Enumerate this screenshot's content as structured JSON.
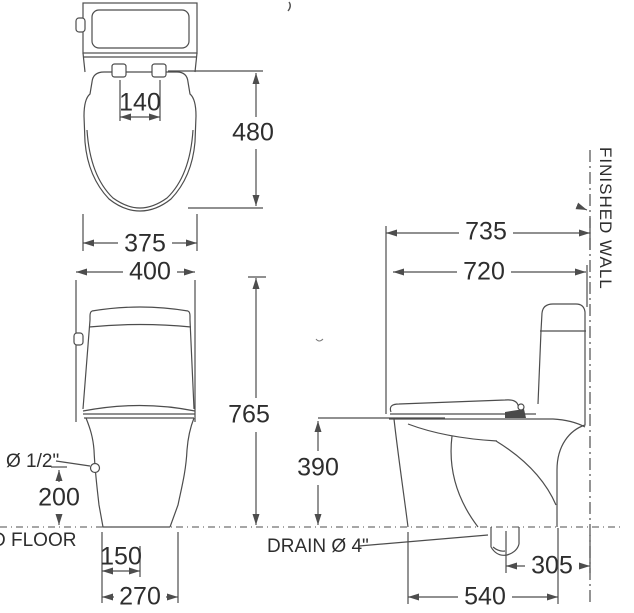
{
  "drawing": {
    "type": "toilet installation dimension diagram",
    "units": "mm",
    "top_view": {
      "hinge_spacing": "140",
      "depth": "480",
      "width": "375"
    },
    "front_view": {
      "width": "400",
      "total_height": "765",
      "inlet_label": "Ø 1/2\"",
      "inlet_height": "200",
      "floor_label": "D FLOOR",
      "base_inner_width": "150",
      "base_width": "270"
    },
    "side_view": {
      "depth_to_wall": "735",
      "body_depth": "720",
      "bowl_height": "390",
      "drain_label": "DRAIN Ø 4\"",
      "drain_to_wall": "305",
      "base_depth": "540",
      "wall_label": "FINISHED WALL"
    }
  }
}
